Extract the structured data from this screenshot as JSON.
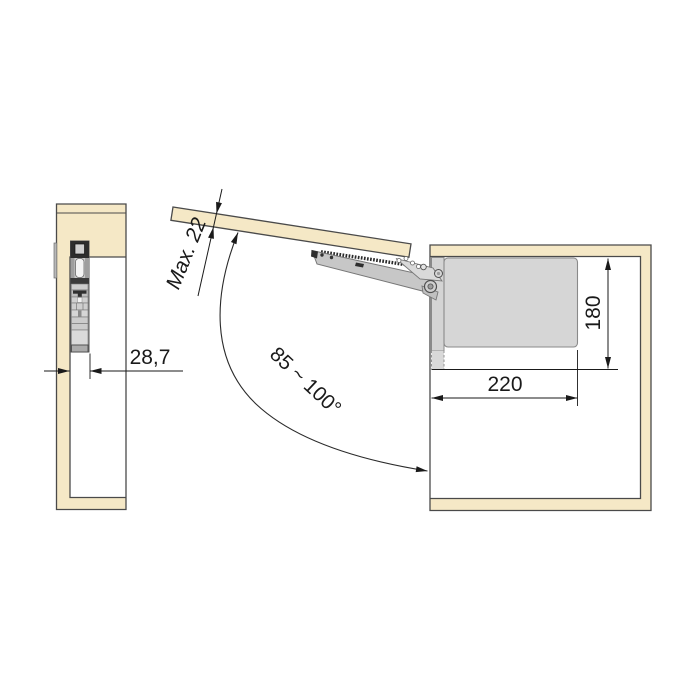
{
  "side_view": {
    "offset_dim": "28,7"
  },
  "front_view": {
    "door_thickness_dim": "Max. 22",
    "opening_angle_dim": "85 ~ 100°",
    "width_dim": "220",
    "height_dim": "180"
  },
  "colors": {
    "wood": "#f5e8c6",
    "outline": "#4a4a4a",
    "mechanism_light": "#d6d6d6",
    "mechanism_dark": "#2e2e2e",
    "dimension_ink": "#1a1a1a"
  }
}
